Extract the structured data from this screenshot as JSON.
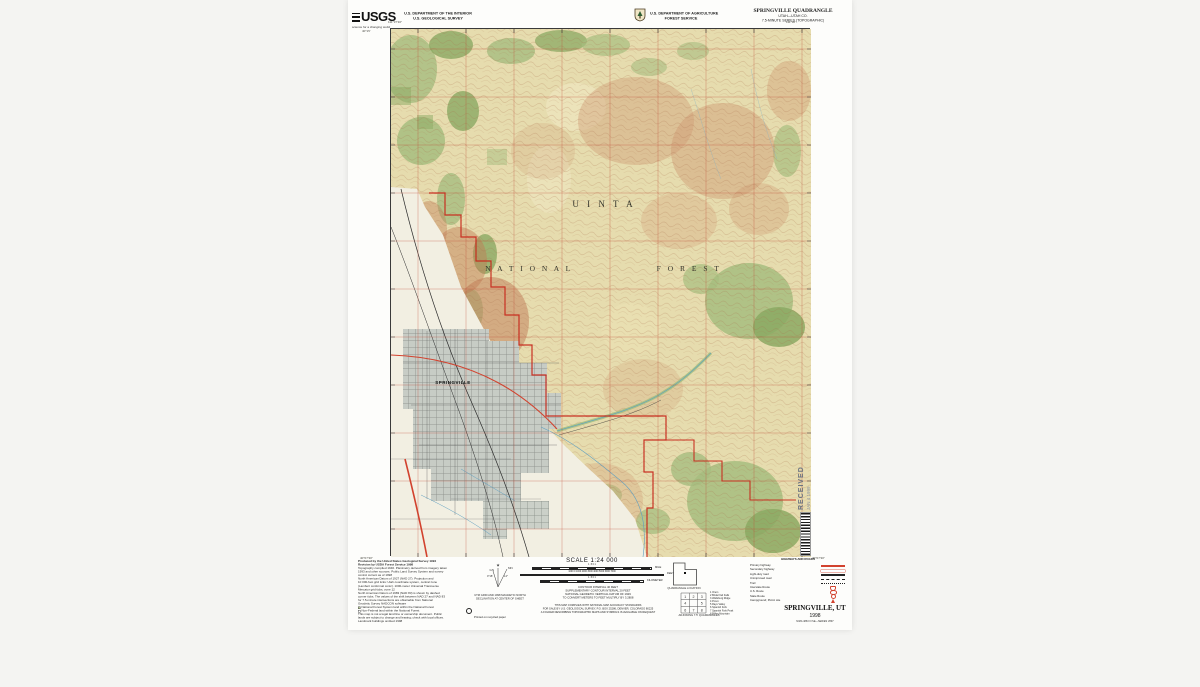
{
  "header": {
    "usgs_logo": "USGS",
    "usgs_tagline": "science for a changing world",
    "interior_line1": "U.S. DEPARTMENT OF THE INTERIOR",
    "interior_line2": "U.S. GEOLOGICAL SURVEY",
    "usda_line1": "U.S. DEPARTMENT OF AGRICULTURE",
    "usda_line2": "FOREST SERVICE",
    "quad_title": "SPRINGVILLE QUADRANGLE",
    "quad_subtitle1": "UTAH—UTAH CO.",
    "quad_subtitle2": "7.5-MINUTE SERIES (TOPOGRAPHIC)"
  },
  "map": {
    "forest_word1": "U I N T A",
    "forest_word2": "N A T I O N A L",
    "forest_word3": "F O R E S T",
    "city_label": "SPRINGVILLE",
    "corner_nw_lat": "40°15'",
    "corner_nw_lon": "111°37'30\"",
    "corner_ne_lon": "111°30'",
    "corner_sw_lat": "40°07'30\"",
    "corner_se_lat": "40°07'30\""
  },
  "stamp": {
    "received": "RECEIVED",
    "date": "JAN 4 1999"
  },
  "footer": {
    "credits": [
      "Produced by the United States Geological Survey 1994",
      "Revision by USDA Forest Service 1998",
      "Topography compiled 1946. Planimetry derived from imagery taken",
      "1993 and other sources. Public Land Survey System and survey",
      "control current as of 1998",
      "North American Datum of 1927 (NAD 27). Projection and",
      "10 000-foot grid ticks: Utah coordinate system, central zone",
      "(Lambert conformal conic). 1000-meter Universal Transverse",
      "Mercator grid ticks, zone 12",
      "North American Datum of 1983 (NAD 83) is shown by dashed",
      "corner ticks. The values of the shift between NAD 27 and NAD 83",
      "for 7.5-minute intersections are obtainable from National",
      "Geodetic Survey NADCON software",
      "This map is not a legal land line or ownership document. Public",
      "lands are subject to change and leasing; check with local offices.",
      "Landmark buildings omitted 1998"
    ],
    "credits_boxed": [
      "National Forest System land within the National Forest",
      "Non-Federal land within the National Forest"
    ],
    "declination": {
      "gn": "GN",
      "mn": "MN",
      "angle_gn": "0°18'",
      "angle_mn": "14°",
      "caption1": "UTM GRID AND 1998 MAGNETIC NORTH",
      "caption2": "DECLINATION AT CENTER OF SHEET"
    },
    "recycle_text": "Printed on recycled paper",
    "scale_title": "SCALE 1:24 000",
    "scale_bars": [
      {
        "nums": "1 .5 0 1",
        "unit": "MILE"
      },
      {
        "nums": "1000 0 1000 2000 3000 4000 5000 6000 7000",
        "unit": "FEET"
      },
      {
        "nums": "1 .5 0 1",
        "unit": "KILOMETER"
      }
    ],
    "contour_lines": [
      "CONTOUR INTERVAL 40 FEET",
      "SUPPLEMENTARY CONTOUR INTERVAL 20 FEET",
      "NATIONAL GEODETIC VERTICAL DATUM OF 1929",
      "TO CONVERT METERS TO FEET MULTIPLY BY 3.2808"
    ],
    "sale_lines": [
      "THIS MAP COMPLIES WITH NATIONAL MAP ACCURACY STANDARDS",
      "FOR SALE BY U.S. GEOLOGICAL SURVEY, P.O. BOX 25286, DENVER, COLORADO 80225",
      "A FOLDER DESCRIBING TOPOGRAPHIC MAPS AND SYMBOLS IS AVAILABLE ON REQUEST"
    ],
    "quad_location_label": "QUADRANGLE LOCATION",
    "adjoining": {
      "caption": "ADJOINING 7.5' QUADRANGLES",
      "grid": [
        "1",
        "2",
        "3",
        "4",
        "5",
        "6",
        "7",
        "8"
      ],
      "names": [
        "1 Orem",
        "2 Bridal Veil Falls",
        "3 Wallsburg Ridge",
        "4 Provo",
        "5 Rays Valley",
        "6 Spanish Fork",
        "7 Spanish Fork Peak",
        "8 Billies Mountain"
      ]
    },
    "legend": {
      "title": "HIGHWAYS AND ROADS",
      "items": [
        {
          "label": "Primary highway"
        },
        {
          "label": "Secondary highway"
        },
        {
          "label": "Light-duty road"
        },
        {
          "label": "Unimproved road"
        },
        {
          "label": "Trail"
        },
        {
          "label": "Interstate Route"
        },
        {
          "label": "U.S. Route"
        },
        {
          "label": "State Route"
        },
        {
          "label": "Campground; Picnic site"
        }
      ]
    },
    "title_block": {
      "name": "SPRINGVILLE, UT",
      "year": "1998",
      "series": "NIMA 4863 III SE—SERIES V897"
    }
  }
}
